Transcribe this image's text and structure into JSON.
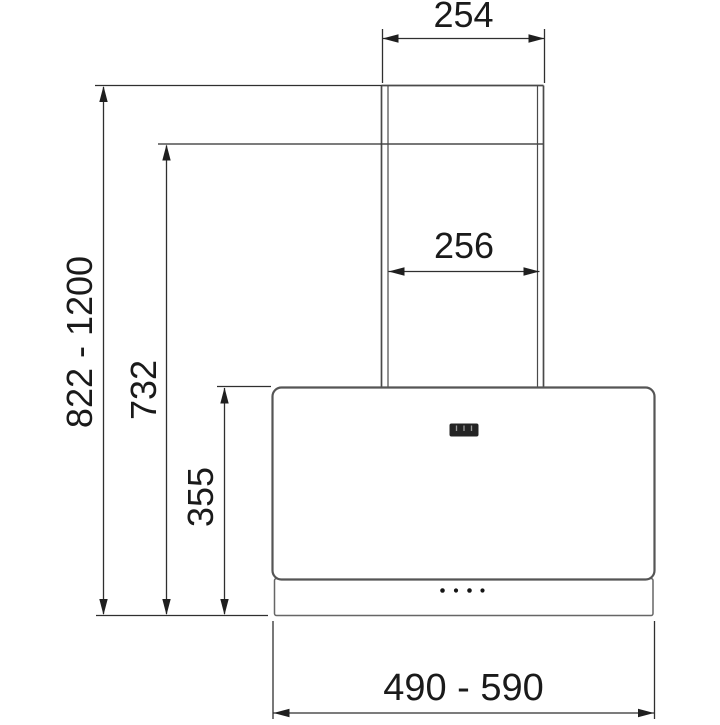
{
  "figure": {
    "description": "Technical line drawing, front view: wall-mounted chimney range hood with installation dimensions",
    "unit": "mm"
  },
  "colors": {
    "background": "#ffffff",
    "outline": "#555555",
    "chimney_outline": "#4a4a4a",
    "dimension_lines": "#2f2f2f",
    "text": "#1a1a1a",
    "display_fill": "#242424"
  },
  "dimensions": {
    "chimney_top_width": "254",
    "chimney_duct_width": "256",
    "overall_height_range": "822 - 1200",
    "chimney_height": "732",
    "hood_body_height": "355",
    "hood_width_range": "490 - 590"
  },
  "hood": {
    "control_dots": 4,
    "has_display": true
  }
}
